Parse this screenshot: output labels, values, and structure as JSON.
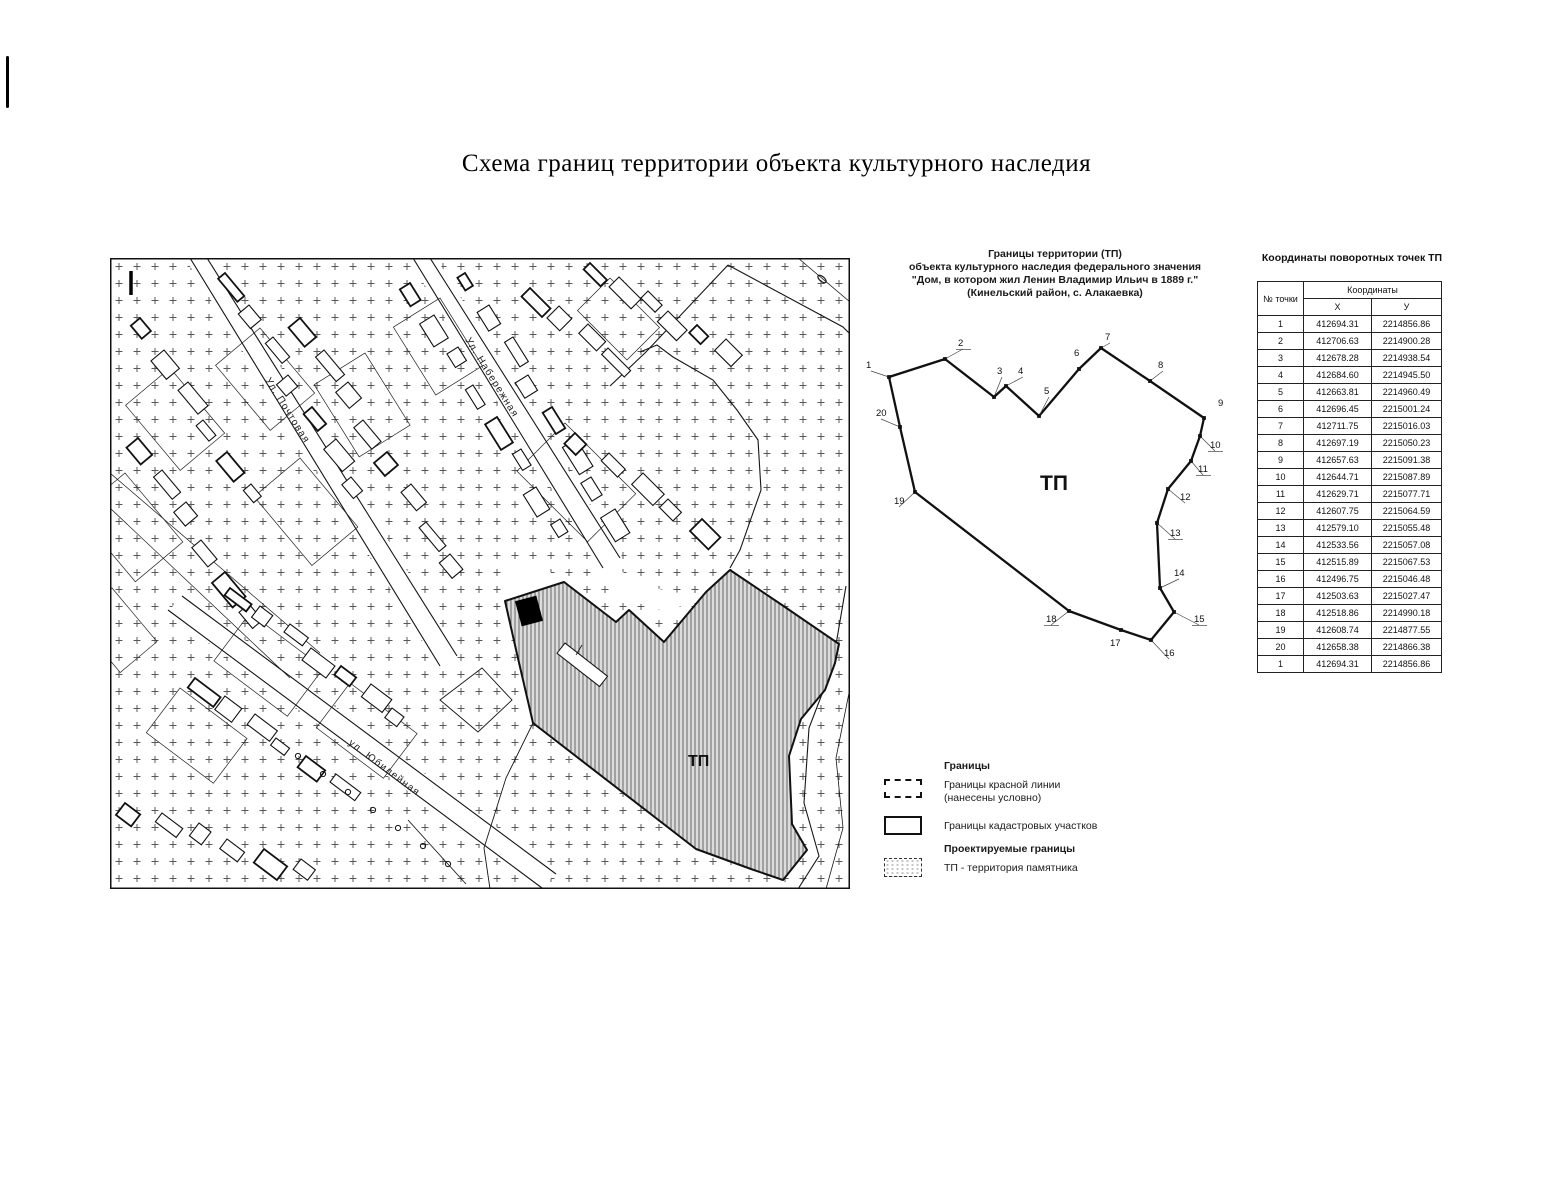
{
  "page": {
    "title": "Схема границ территории объекта культурного наследия"
  },
  "map": {
    "corner_mark": "I",
    "territory_label": "ТП",
    "streets": [
      {
        "label": "Ул. Набережная"
      },
      {
        "label": "Ул. Почтовая"
      },
      {
        "label": "ул. Юбилейная"
      }
    ]
  },
  "diagram": {
    "header_lines": [
      "Границы территории (ТП)",
      "объекта культурного наследия федерального значения",
      "\"Дом, в котором жил Ленин Владимир Ильич в 1889 г.\"",
      "(Кинельский район, с. Алакаевка)"
    ],
    "territory_label": "ТП",
    "point_labels": [
      "1",
      "2",
      "3",
      "4",
      "5",
      "6",
      "7",
      "8",
      "9",
      "10",
      "11",
      "12",
      "13",
      "14",
      "15",
      "16",
      "17",
      "18",
      "19",
      "20"
    ]
  },
  "table": {
    "title": "Координаты поворотных точек ТП",
    "headers": {
      "point": "№ точки",
      "coords": "Координаты",
      "x": "X",
      "y": "У"
    },
    "rows": [
      [
        "1",
        "412694.31",
        "2214856.86"
      ],
      [
        "2",
        "412706.63",
        "2214900.28"
      ],
      [
        "3",
        "412678.28",
        "2214938.54"
      ],
      [
        "4",
        "412684.60",
        "2214945.50"
      ],
      [
        "5",
        "412663.81",
        "2214960.49"
      ],
      [
        "6",
        "412696.45",
        "2215001.24"
      ],
      [
        "7",
        "412711.75",
        "2215016.03"
      ],
      [
        "8",
        "412697.19",
        "2215050.23"
      ],
      [
        "9",
        "412657.63",
        "2215091.38"
      ],
      [
        "10",
        "412644.71",
        "2215087.89"
      ],
      [
        "11",
        "412629.71",
        "2215077.71"
      ],
      [
        "12",
        "412607.75",
        "2215064.59"
      ],
      [
        "13",
        "412579.10",
        "2215055.48"
      ],
      [
        "14",
        "412533.56",
        "2215057.08"
      ],
      [
        "15",
        "412515.89",
        "2215067.53"
      ],
      [
        "16",
        "412496.75",
        "2215046.48"
      ],
      [
        "17",
        "412503.63",
        "2215027.47"
      ],
      [
        "18",
        "412518.86",
        "2214990.18"
      ],
      [
        "19",
        "412608.74",
        "2214877.55"
      ],
      [
        "20",
        "412658.38",
        "2214866.38"
      ],
      [
        "1",
        "412694.31",
        "2214856.86"
      ]
    ]
  },
  "legend": {
    "boundaries_heading": "Границы",
    "red_line_label_1": "Границы красной линии",
    "red_line_label_2": "(нанесены условно)",
    "cadastral_label": "Границы кадастровых участков",
    "projected_heading": "Проектируемые границы",
    "tp_label": "ТП - территория памятника"
  }
}
